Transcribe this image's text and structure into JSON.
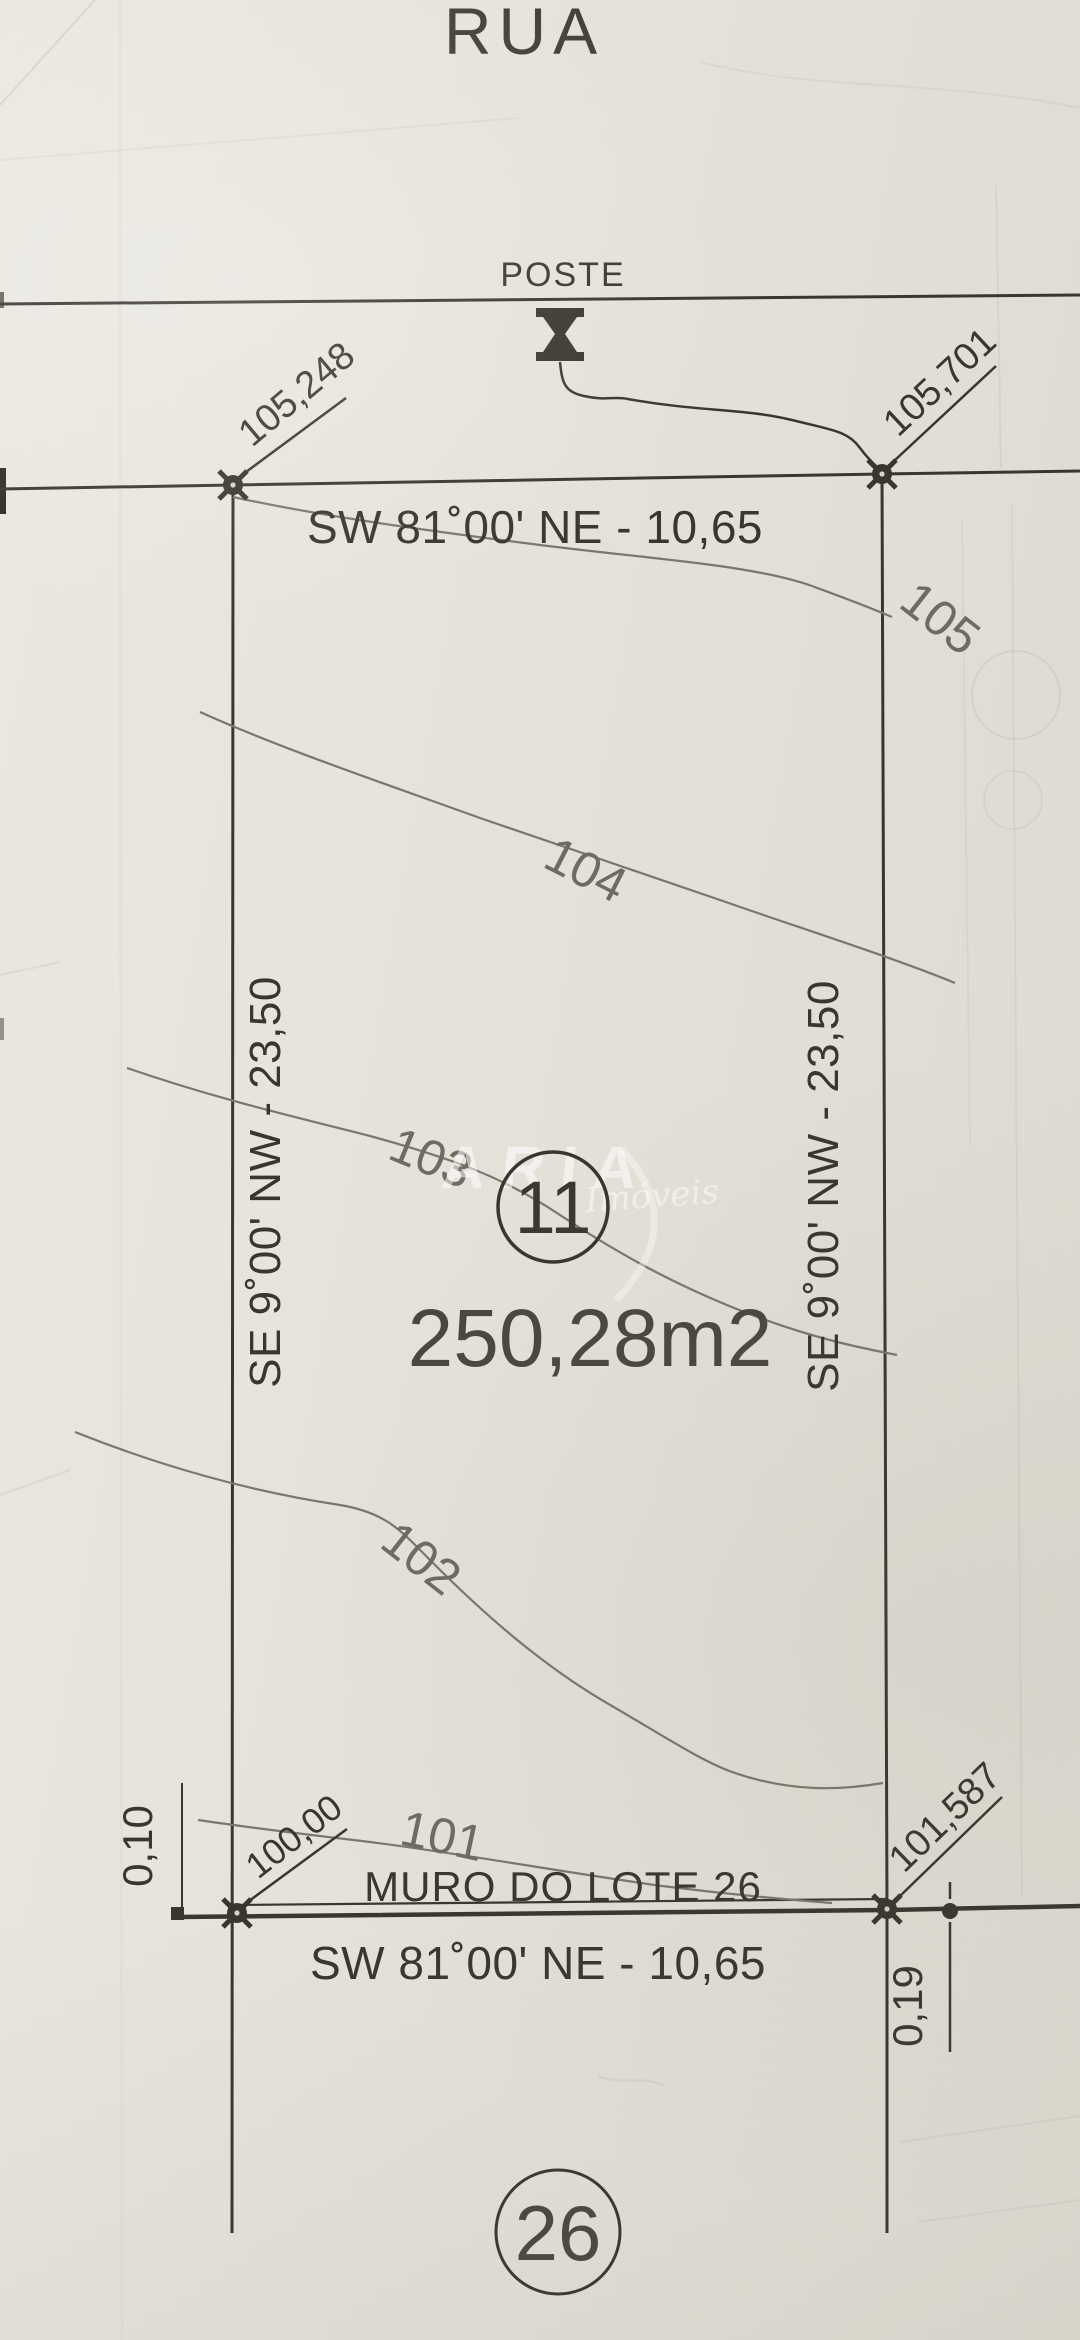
{
  "street": {
    "name": "RUA"
  },
  "pole": {
    "label": "POSTE"
  },
  "dimensions": {
    "front": "SW 81˚00' NE - 10,65",
    "back": "SW 81˚00' NE - 10,65",
    "left": "SE 9˚00' NW - 23,50",
    "right": "SE 9˚00' NW - 23,50"
  },
  "corner_elevations": {
    "top_left": "105,248",
    "top_right": "105,701",
    "bottom_left": "100,00",
    "bottom_right": "101,587"
  },
  "offsets": {
    "left": "0,10",
    "right": "0,19"
  },
  "contours": {
    "labels": [
      "105",
      "104",
      "103",
      "102",
      "101"
    ]
  },
  "lot": {
    "number": "11",
    "area": "250,28m2",
    "wall_label": "MURO DO LOTE 26"
  },
  "adjacent_lot": {
    "number": "26"
  },
  "watermark": {
    "brand": "ARIA",
    "sub": "Imóveis"
  },
  "colors": {
    "paper": "#e6e3db",
    "ink": "#393630",
    "contour": "#7b766d"
  }
}
